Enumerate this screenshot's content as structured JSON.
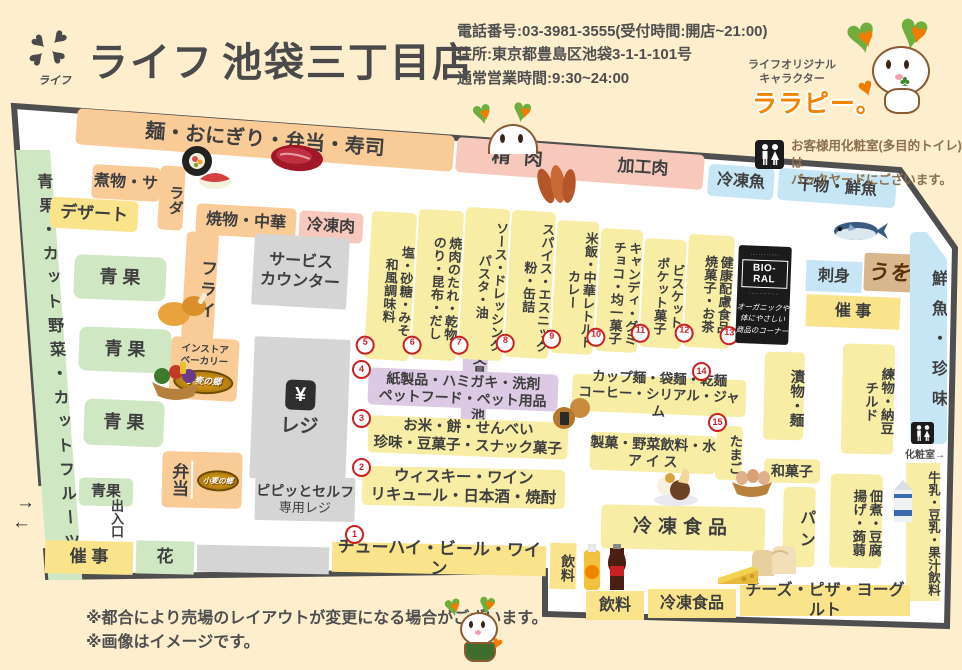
{
  "header": {
    "brand": "ライフ",
    "store_name": "池袋三丁目店",
    "logo_small_text": "ライフ",
    "phone": "電話番号:03-3981-3555(受付時間:開店~21:00)",
    "address": "住所:東京都豊島区池袋3-1-1-101号",
    "hours": "通常営業時間:9:30~24:00",
    "mascot_caption_line1": "ライフオリジナル",
    "mascot_caption_line2": "キャラクター",
    "mascot_name": "ララピー。"
  },
  "notice": {
    "line1": "お客様用化粧室(多目的トイレ)は",
    "line2": "バックヤードにございます。"
  },
  "map": {
    "top_bands": {
      "noodle": "麺・おにぎり・弁当・寿司",
      "meat": "精 肉",
      "processed_meat": "加工肉",
      "frozen_fish": "冷凍魚",
      "dried_fish": "干物・鮮魚"
    },
    "labels": {
      "produce_side": "青果・カット野菜・カットフルーツ",
      "nimono": "煮物・サ",
      "nimono_tail": "ラダ",
      "dessert": "デザート",
      "yakimono": "焼物・中華",
      "frozen_meat": "冷凍肉",
      "fry": "フライ",
      "bakery_line1": "インストア",
      "bakery_line2": "ベーカリー",
      "komugi_logo": "小麦の郷",
      "service_line1": "サービス",
      "service_line2": "カウンター",
      "register": "レジ",
      "yen": "¥",
      "bungu": "文具・電池",
      "pipitto_line1": "ピピッとセルフ",
      "pipitto_line2": "専用レジ",
      "bento": "弁当",
      "produce_box": "青 果",
      "produce_box_small": "青果",
      "exit": "出入口",
      "saiji_left": "催 事",
      "hana": "花",
      "chuhai": "チューハイ・ビール・ワイン",
      "inryo_v": "飲料",
      "kami_line1": "紙製品・ハミガキ・洗剤",
      "kami_line2": "ペットフード・ペット用品",
      "okome_line1": "お米・餅・せんべい",
      "okome_line2": "珍味・豆菓子・スナック菓子",
      "whisky_line1": "ウィスキー・ワイン",
      "whisky_line2": "リキュール・日本酒・焼酎",
      "cupmen_line1": "カップ麺・袋麺・乾麺",
      "cupmen_line2": "コーヒー・シリアル・ジャム",
      "seika_line1": "製菓・野菜飲料・水",
      "seika_line2": "ア イ ス",
      "tamago": "たまご",
      "frozen_big": "冷凍食品",
      "sashimi": "刺身",
      "uosushi": "うを鮨",
      "saiji_right": "催 事",
      "sengyo_chinmi": "鮮魚・珍味",
      "tsukemono": "漬物・麺",
      "nerimono_col1": "練物・納豆",
      "nerimono_col2": "チルド",
      "wagashi": "和菓子",
      "pan": "パン",
      "tsukudani_col1": "佃煮・豆腐",
      "tsukudani_col2": "揚げ・蒟蒻",
      "gyunyu": "牛乳・豆乳・果汁飲料",
      "kesho": "化粧室",
      "bottom_inryo": "飲料",
      "bottom_frozen": "冷凍食品",
      "bottom_cheese": "チーズ・ピザ・ヨーグルト"
    },
    "biolal": {
      "title": "BIO-RAL",
      "line1": "オーガニックや",
      "line2": "体にやさしい",
      "line3": "商品のコーナー"
    },
    "aisles": [
      {
        "num": "5",
        "col1": "塩・砂糖・みそ",
        "col2": "和風調味料"
      },
      {
        "num": "6",
        "col1": "焼肉のたれ・乾物",
        "col2": "のり・昆布・だし"
      },
      {
        "num": "7",
        "col1": "ソース・ドレッシング",
        "col2": "パスタ・油"
      },
      {
        "num": "8",
        "col1": "スパイス・エスニック",
        "col2": "粉・缶詰"
      },
      {
        "num": "9",
        "col1": "米飯・中華レトルト",
        "col2": "カレー"
      },
      {
        "num": "10",
        "col1": "キャンディ・グミ",
        "col2": "チョコ・均一菓子"
      },
      {
        "num": "11",
        "col1": "ビスケット",
        "col2": "ポケット菓子"
      },
      {
        "num": "12",
        "col1": "健康配慮食品",
        "col2": "焼菓子・お茶"
      }
    ],
    "numbers": {
      "n1": "1",
      "n2": "2",
      "n3": "3",
      "n4": "4",
      "n13": "13",
      "n14": "14",
      "n15": "15"
    }
  },
  "icons": {
    "arrow_right": "→",
    "arrow_left": "←"
  },
  "palette": {
    "cream": "#fdeecd",
    "border": "#4f4f4f",
    "orange": "#f8cb97",
    "pink": "#f7c9bc",
    "blue": "#c6e6f5",
    "green": "#cfe7c2",
    "yellow": "#f9e48b",
    "lavender": "#dccae4",
    "gray": "#d5d5d6",
    "brand_orange": "#f08300",
    "red": "#c92121"
  },
  "footer": {
    "note1": "※都合により売場のレイアウトが変更になる場合がございます。",
    "note2": "※画像はイメージです。"
  }
}
